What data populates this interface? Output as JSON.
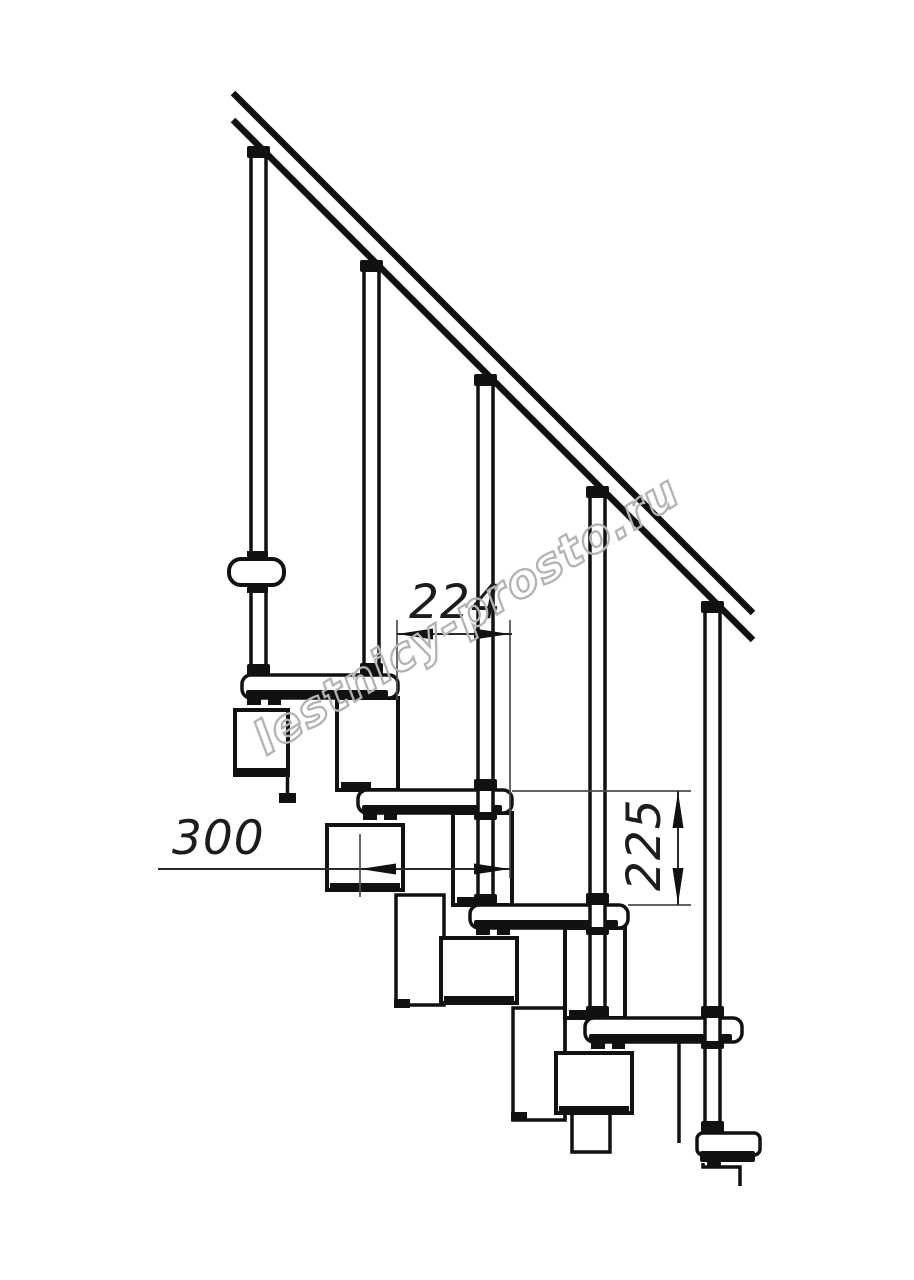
{
  "drawing": {
    "title": "staircase-side-elevation",
    "background_color": "#ffffff",
    "line_color": "#111111",
    "dimension_line_color": "#4d4d4d",
    "dimension_text_color": "#1c1c1c",
    "watermark": {
      "text": "lestnicy-prosto.ru",
      "color": "#b3b3b3",
      "rotation_deg": -31.5
    },
    "dimensions": [
      {
        "value": "224",
        "orientation": "horizontal"
      },
      {
        "value": "300",
        "orientation": "horizontal"
      },
      {
        "value": "225",
        "orientation": "vertical"
      }
    ],
    "counts": {
      "treads": 5,
      "balusters": 5,
      "handrail_lines": 2
    }
  }
}
